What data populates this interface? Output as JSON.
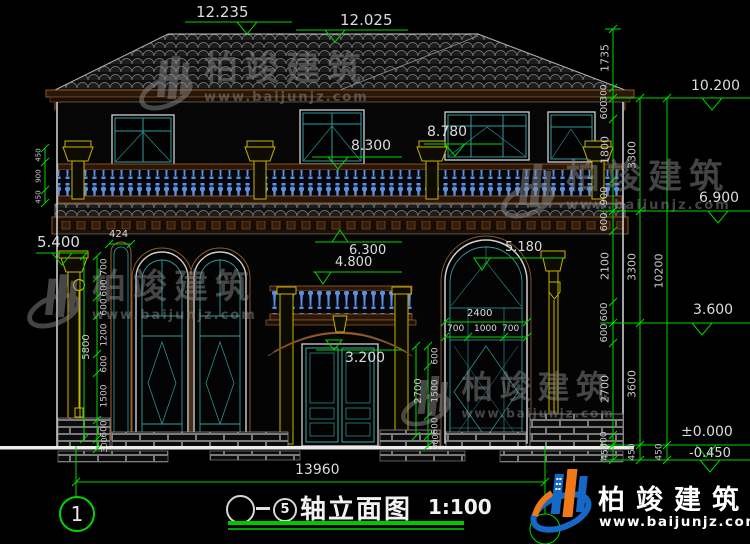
{
  "drawing": {
    "title": {
      "axis_from": "",
      "axis_to": "5",
      "name": "轴立面图",
      "scale": "1:100"
    },
    "axis_bubbles": {
      "left": "1"
    },
    "total_width": "13960",
    "levels": {
      "ridge": "12.235",
      "ridge2": "12.025",
      "left_capital": "5.400",
      "f2_capital": "8.780",
      "f2_window": "8.300",
      "balcony_top": "6.300",
      "balcony_floor": "4.800",
      "arch_window_top": "5.180",
      "door_arch": "3.200",
      "r_eave": "10.200",
      "r_f2_floor": "6.900",
      "r_f1_top": "3.600",
      "r_ground": "±0.000",
      "r_outdoor": "-0.450"
    },
    "chains": {
      "right_inner": [
        "1735",
        "300",
        "600",
        "1800",
        "900",
        "600",
        "2100",
        "600",
        "600",
        "2700",
        "300",
        "450"
      ],
      "right_mid": [
        "3300",
        "3300",
        "3600",
        "450"
      ],
      "right_outer": [
        "10200",
        "450"
      ],
      "left_window": [
        "700",
        "600",
        "600",
        "1200",
        "600",
        "1500",
        "600",
        "300"
      ],
      "left_window_total": "5800",
      "capital_detail": [
        "450",
        "900",
        "450"
      ],
      "door_side": [
        "600",
        "1500",
        "600",
        "300"
      ],
      "door_side_total": "2700",
      "right_window_width_total": "2400",
      "right_window_width": [
        "700",
        "1000",
        "700"
      ],
      "niche_width": "424"
    }
  },
  "watermark": {
    "brand": "柏竣建筑",
    "url": "www.baijunjz.com"
  },
  "logo": {
    "brand": "柏竣建筑",
    "url": "www.baijunjz.com"
  }
}
